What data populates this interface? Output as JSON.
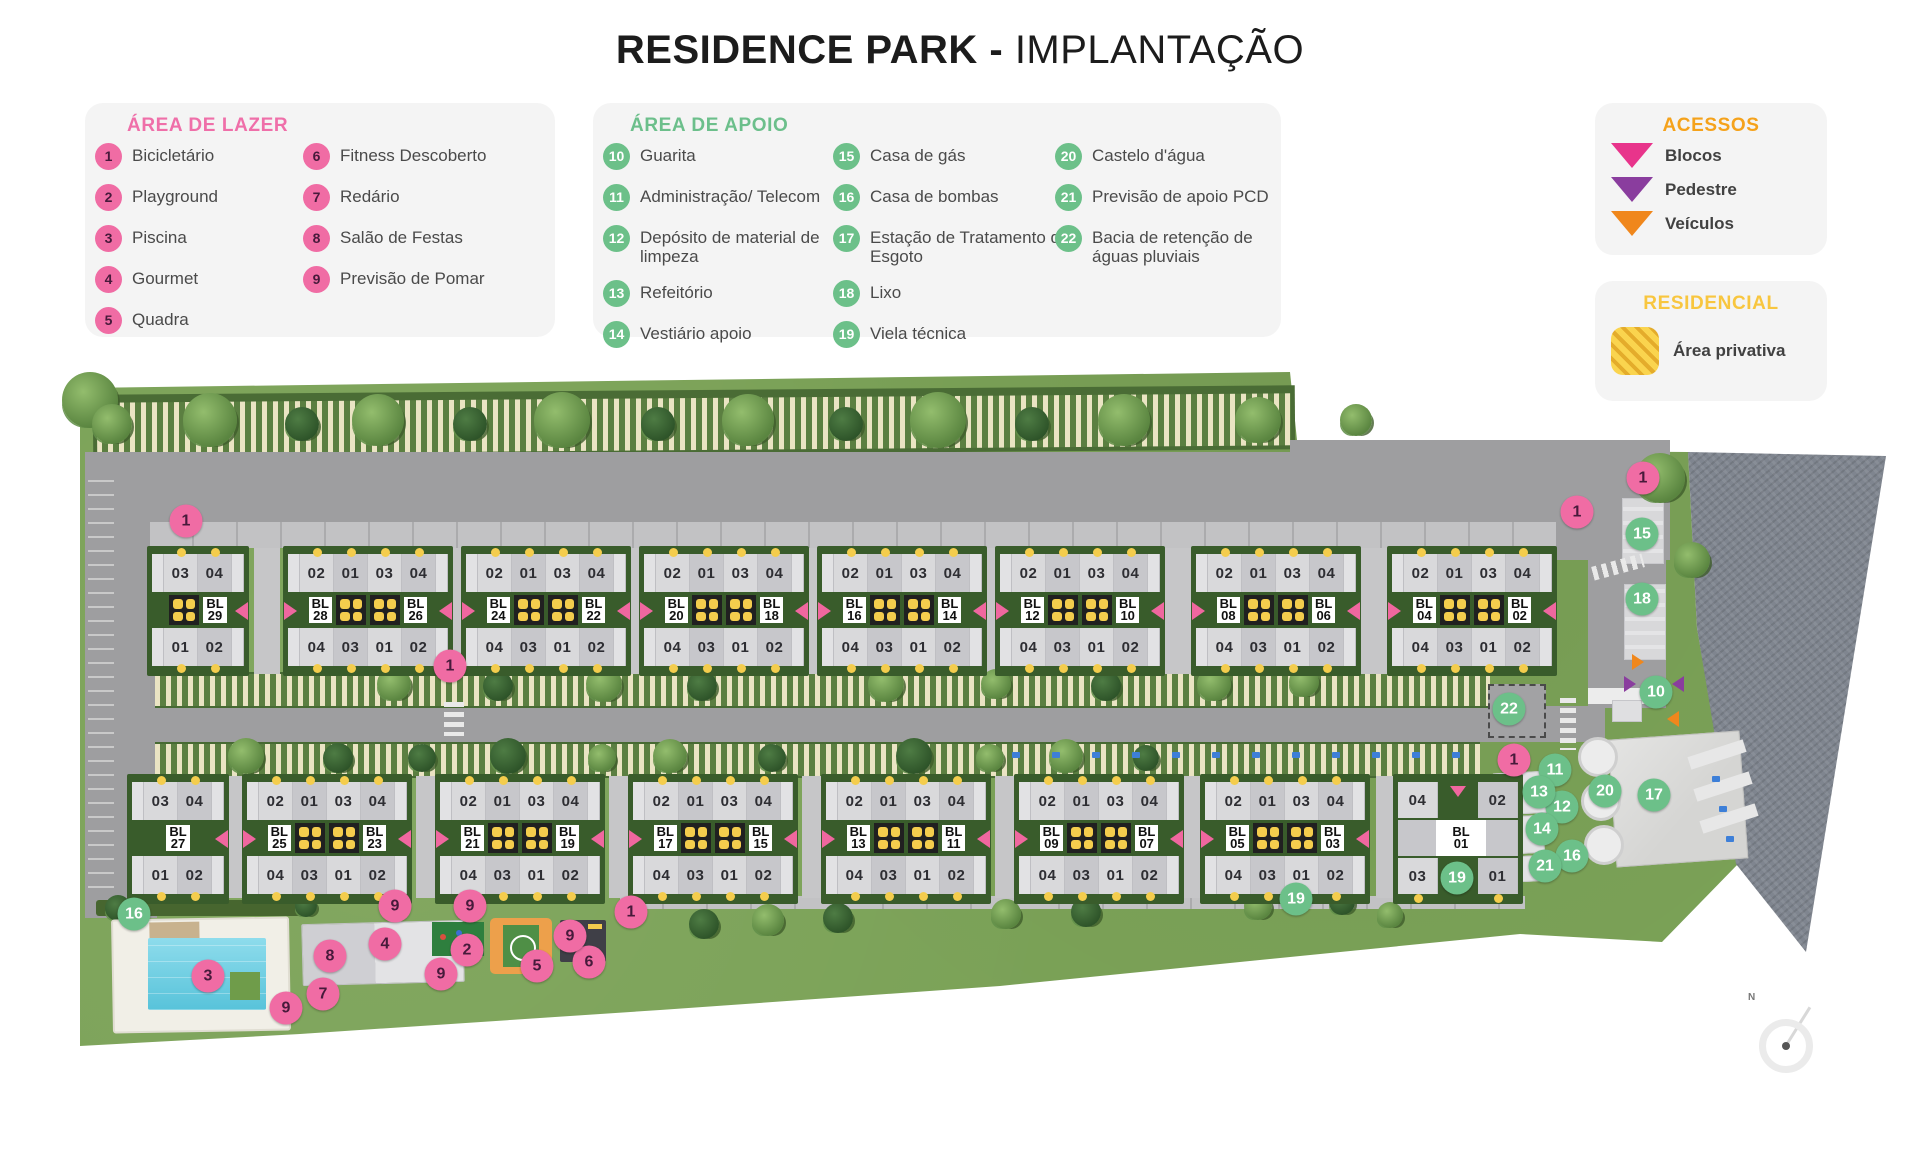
{
  "title": {
    "bold": "RESIDENCE PARK -",
    "regular": " IMPLANTAÇÃO"
  },
  "colors": {
    "pink_badge": "#f06ca4",
    "green_badge": "#6cc089",
    "accent_lazer": "#ef6fa9",
    "accent_apoio": "#6cbf8b",
    "accent_acessos": "#f5a21b",
    "accent_residencial": "#f8c63f",
    "arrow_blocos": "#e8348b",
    "arrow_pedestre": "#8a3d9e",
    "arrow_veiculos": "#f0871c",
    "area_privativa": "#fad44e"
  },
  "legends": {
    "lazer": {
      "title": "ÁREA DE LAZER",
      "items": [
        {
          "num": "1",
          "label": "Bicicletário"
        },
        {
          "num": "2",
          "label": "Playground"
        },
        {
          "num": "3",
          "label": "Piscina"
        },
        {
          "num": "4",
          "label": "Gourmet"
        },
        {
          "num": "5",
          "label": "Quadra"
        },
        {
          "num": "6",
          "label": "Fitness Descoberto"
        },
        {
          "num": "7",
          "label": "Redário"
        },
        {
          "num": "8",
          "label": "Salão de Festas"
        },
        {
          "num": "9",
          "label": "Previsão de Pomar"
        }
      ]
    },
    "apoio": {
      "title": "ÁREA DE APOIO",
      "items": [
        {
          "num": "10",
          "label": "Guarita"
        },
        {
          "num": "11",
          "label": "Administração/ Telecom"
        },
        {
          "num": "12",
          "label": "Depósito de material de limpeza"
        },
        {
          "num": "13",
          "label": "Refeitório"
        },
        {
          "num": "14",
          "label": "Vestiário apoio"
        },
        {
          "num": "15",
          "label": "Casa de gás"
        },
        {
          "num": "16",
          "label": "Casa de bombas"
        },
        {
          "num": "17",
          "label": "Estação de Tratamento de Esgoto"
        },
        {
          "num": "18",
          "label": "Lixo"
        },
        {
          "num": "19",
          "label": "Viela técnica"
        },
        {
          "num": "20",
          "label": "Castelo d'água"
        },
        {
          "num": "21",
          "label": "Previsão de apoio PCD"
        },
        {
          "num": "22",
          "label": "Bacia de retenção de águas pluviais"
        }
      ]
    },
    "acessos": {
      "title": "ACESSOS",
      "items": [
        {
          "label": "Blocos",
          "color": "#e8348b"
        },
        {
          "label": "Pedestre",
          "color": "#8a3d9e"
        },
        {
          "label": "Veículos",
          "color": "#f0871c"
        }
      ]
    },
    "residencial": {
      "title": "RESIDENCIAL",
      "items": [
        {
          "label": "Área privativa",
          "swatch": "#fad44e"
        }
      ]
    }
  },
  "map": {
    "compass_label": "N",
    "unit_sets": {
      "pair_top": [
        "02",
        "01",
        "03",
        "04"
      ],
      "pair_bottom": [
        "04",
        "03",
        "01",
        "02"
      ],
      "half_top": [
        "03",
        "04"
      ],
      "half_bottom": [
        "01",
        "02"
      ],
      "single_top": [
        "04",
        "02"
      ],
      "single_bottom": [
        "03",
        "01"
      ]
    },
    "block_prefix": "BL",
    "blocks_row1": [
      {
        "type": "half",
        "bl": "29",
        "x": 152,
        "band": "sq"
      },
      {
        "type": "pair",
        "bl_left": "28",
        "bl_right": "26",
        "x": 288
      },
      {
        "type": "pair",
        "bl_left": "24",
        "bl_right": "22",
        "x": 466
      },
      {
        "type": "pair",
        "bl_left": "20",
        "bl_right": "18",
        "x": 644
      },
      {
        "type": "pair",
        "bl_left": "16",
        "bl_right": "14",
        "x": 822
      },
      {
        "type": "pair",
        "bl_left": "12",
        "bl_right": "10",
        "x": 1000
      },
      {
        "type": "pair",
        "bl_left": "08",
        "bl_right": "06",
        "x": 1196
      },
      {
        "type": "pair",
        "bl_left": "04",
        "bl_right": "02",
        "x": 1392
      }
    ],
    "blocks_row2": [
      {
        "type": "half",
        "bl": "27",
        "x": 132,
        "band": "plain"
      },
      {
        "type": "pair",
        "bl_left": "25",
        "bl_right": "23",
        "x": 247
      },
      {
        "type": "pair",
        "bl_left": "21",
        "bl_right": "19",
        "x": 440
      },
      {
        "type": "pair",
        "bl_left": "17",
        "bl_right": "15",
        "x": 633
      },
      {
        "type": "pair",
        "bl_left": "13",
        "bl_right": "11",
        "x": 826
      },
      {
        "type": "pair",
        "bl_left": "09",
        "bl_right": "07",
        "x": 1019
      },
      {
        "type": "pair",
        "bl_left": "05",
        "bl_right": "03",
        "x": 1205
      },
      {
        "type": "single",
        "bl": "01",
        "x": 1398
      }
    ],
    "markers": [
      {
        "num": "1",
        "kind": "pink",
        "x": 186,
        "y": 521
      },
      {
        "num": "1",
        "kind": "pink",
        "x": 450,
        "y": 666
      },
      {
        "num": "1",
        "kind": "pink",
        "x": 1577,
        "y": 512
      },
      {
        "num": "1",
        "kind": "pink",
        "x": 1643,
        "y": 478
      },
      {
        "num": "1",
        "kind": "pink",
        "x": 1514,
        "y": 760
      },
      {
        "num": "1",
        "kind": "pink",
        "x": 631,
        "y": 912
      },
      {
        "num": "2",
        "kind": "pink",
        "x": 467,
        "y": 950
      },
      {
        "num": "3",
        "kind": "pink",
        "x": 208,
        "y": 976
      },
      {
        "num": "4",
        "kind": "pink",
        "x": 385,
        "y": 944
      },
      {
        "num": "5",
        "kind": "pink",
        "x": 537,
        "y": 966
      },
      {
        "num": "6",
        "kind": "pink",
        "x": 589,
        "y": 962
      },
      {
        "num": "7",
        "kind": "pink",
        "x": 323,
        "y": 994
      },
      {
        "num": "8",
        "kind": "pink",
        "x": 330,
        "y": 956
      },
      {
        "num": "9",
        "kind": "pink",
        "x": 395,
        "y": 906
      },
      {
        "num": "9",
        "kind": "pink",
        "x": 470,
        "y": 906
      },
      {
        "num": "9",
        "kind": "pink",
        "x": 441,
        "y": 974
      },
      {
        "num": "9",
        "kind": "pink",
        "x": 286,
        "y": 1008
      },
      {
        "num": "9",
        "kind": "pink",
        "x": 570,
        "y": 936
      },
      {
        "num": "10",
        "kind": "green",
        "x": 1656,
        "y": 692
      },
      {
        "num": "11",
        "kind": "green",
        "x": 1555,
        "y": 770
      },
      {
        "num": "12",
        "kind": "green",
        "x": 1562,
        "y": 807
      },
      {
        "num": "13",
        "kind": "green",
        "x": 1539,
        "y": 792
      },
      {
        "num": "14",
        "kind": "green",
        "x": 1542,
        "y": 829
      },
      {
        "num": "15",
        "kind": "green",
        "x": 1642,
        "y": 534
      },
      {
        "num": "16",
        "kind": "green",
        "x": 1572,
        "y": 856
      },
      {
        "num": "16",
        "kind": "green",
        "x": 134,
        "y": 914
      },
      {
        "num": "17",
        "kind": "green",
        "x": 1654,
        "y": 795
      },
      {
        "num": "18",
        "kind": "green",
        "x": 1642,
        "y": 599
      },
      {
        "num": "19",
        "kind": "green",
        "x": 1296,
        "y": 899
      },
      {
        "num": "19",
        "kind": "green",
        "x": 1457,
        "y": 878
      },
      {
        "num": "20",
        "kind": "green",
        "x": 1605,
        "y": 791
      },
      {
        "num": "21",
        "kind": "green",
        "x": 1545,
        "y": 866
      },
      {
        "num": "22",
        "kind": "green",
        "x": 1509,
        "y": 709
      }
    ],
    "access_arrows": [
      {
        "kind": "pedestre",
        "dir": "right",
        "x": 1630,
        "y": 684
      },
      {
        "kind": "pedestre",
        "dir": "left",
        "x": 1678,
        "y": 684
      },
      {
        "kind": "veiculos",
        "dir": "right",
        "x": 1638,
        "y": 662
      },
      {
        "kind": "veiculos",
        "dir": "left",
        "x": 1673,
        "y": 719
      }
    ]
  }
}
